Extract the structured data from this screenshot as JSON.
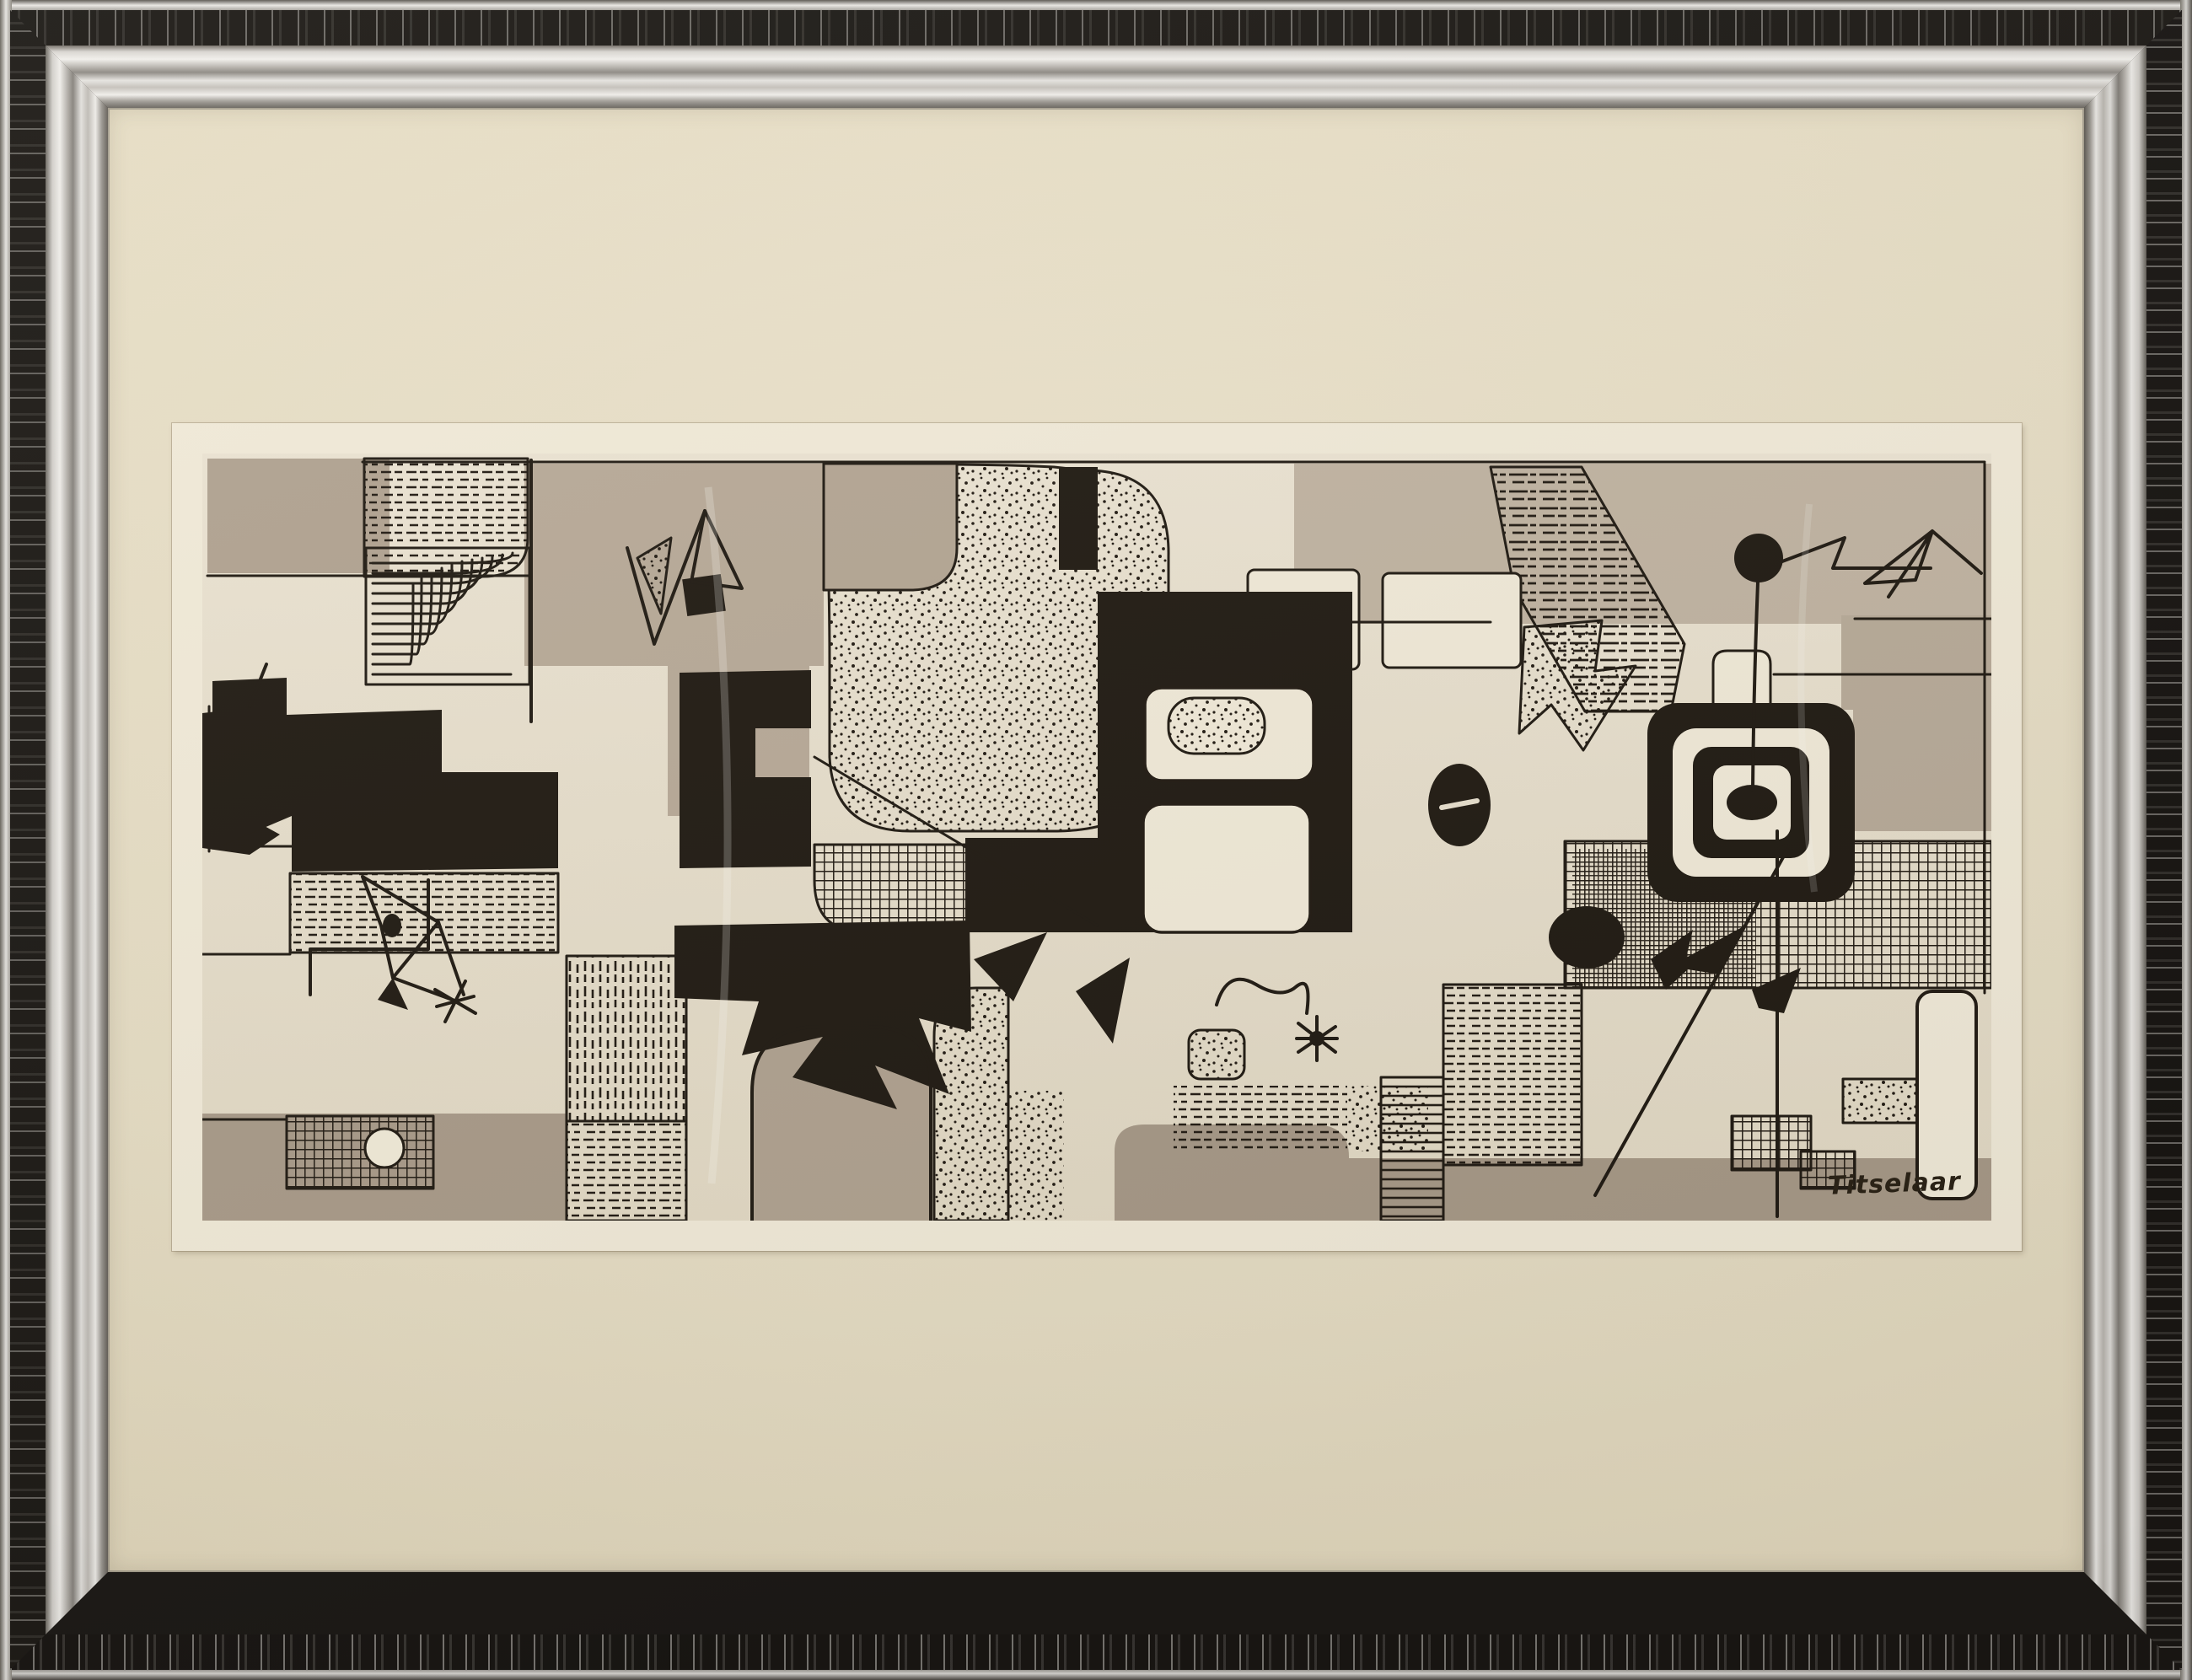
{
  "artwork": {
    "signature": "Titselaar",
    "kind": "abstract-ink-and-wash-drawing",
    "motifs": [
      "bird-figure",
      "asterisk-star",
      "concentric-maze",
      "stipple-field",
      "crosshatch-band",
      "dash-hatch-block",
      "target-rings",
      "wire-and-ball",
      "paper-plane-arrow"
    ]
  },
  "frame": {
    "style": "distressed-silver-molding",
    "mat": "cream-mat-with-bevel-window"
  },
  "palette": {
    "paper": "#e9e1cf",
    "ink": "#231d15",
    "wash": "#b7aa97",
    "wash-dark": "#a99b89",
    "wash-light": "#c2b5a3",
    "mat": "#ece3cc",
    "mat-dark": "#ddd2b5",
    "bevel": "#f2ebd9",
    "silver": "#c6c2bc",
    "silver-hi": "#f0eeea",
    "silver-dark": "#75716b",
    "frame-dark": "#1c1916"
  }
}
